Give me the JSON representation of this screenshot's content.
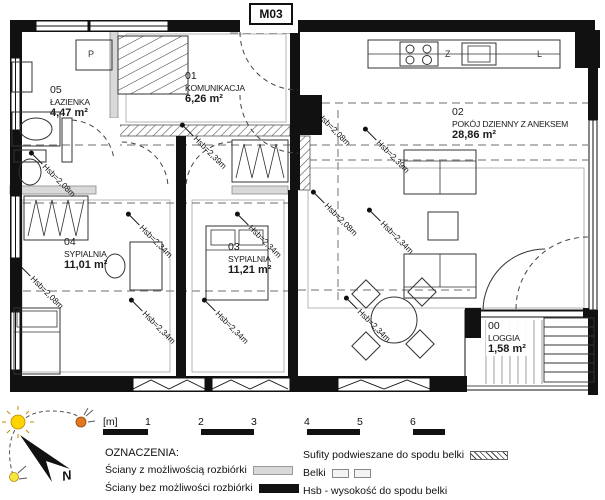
{
  "title_box": {
    "label": "M03"
  },
  "rooms": [
    {
      "id": "05",
      "name": "ŁAZIENKA",
      "area": "4,47 m²"
    },
    {
      "id": "01",
      "name": "KOMUNIKACJA",
      "area": "6,26 m²"
    },
    {
      "id": "02",
      "name": "POKÓJ DZIENNY Z ANEKSEM",
      "area": "28,86 m²"
    },
    {
      "id": "04",
      "name": "SYPIALNIA",
      "area": "11,01 m²"
    },
    {
      "id": "03",
      "name": "SYPIALNIA",
      "area": "11,21 m²"
    },
    {
      "id": "00",
      "name": "LOGGIA",
      "area": "1,58 m²"
    }
  ],
  "height_labels": [
    {
      "text": "Hsb=2,08m",
      "location": "bathroom"
    },
    {
      "text": "Hsb=2,39m",
      "location": "hall"
    },
    {
      "text": "Hsb=2,08m",
      "location": "living-top-left"
    },
    {
      "text": "Hsb=2,39m",
      "location": "living-top-right"
    },
    {
      "text": "Hsb=2,08m",
      "location": "living-mid-left"
    },
    {
      "text": "Hsb=2,34m",
      "location": "living-mid-right"
    },
    {
      "text": "Hsb=2,34m",
      "location": "bedroom04-top"
    },
    {
      "text": "Hsb=2,34m",
      "location": "bedroom03-top"
    },
    {
      "text": "Hsb=2,08m",
      "location": "bedroom04-left"
    },
    {
      "text": "Hsb=2,34m",
      "location": "bedroom04-bottom"
    },
    {
      "text": "Hsb=2,34m",
      "location": "bedroom03-bottom"
    },
    {
      "text": "Hsb=2,34m",
      "location": "living-bottom"
    }
  ],
  "kitchen": {
    "sink_label": "Z",
    "fridge_label": "L"
  },
  "bathroom": {
    "washer_label": "P"
  },
  "compass": {
    "north_label": "N"
  },
  "scale_bar": {
    "unit": "[m]",
    "ticks": [
      "1",
      "2",
      "3",
      "4",
      "5",
      "6"
    ]
  },
  "legend": {
    "heading": "OZNACZENIA:",
    "left_items": [
      {
        "label": "Ściany z możliwością rozbiórki",
        "swatch": "gray-wall"
      },
      {
        "label": "Ściany bez możliwości rozbiórki",
        "swatch": "black-wall"
      }
    ],
    "right_items": [
      {
        "label": "Sufity podwieszane do spodu belki",
        "swatch": "hatch"
      },
      {
        "label": "Belki",
        "swatch": "beams"
      },
      {
        "label": "Hsb - wysokość do spodu belki",
        "swatch": "none"
      }
    ]
  },
  "colors": {
    "wall_black": "#111111",
    "wall_gray": "#d9d9d9",
    "sun_yellow": "#ffd400",
    "sun_orange": "#e07820",
    "dash_gray": "#8a8a8a"
  }
}
